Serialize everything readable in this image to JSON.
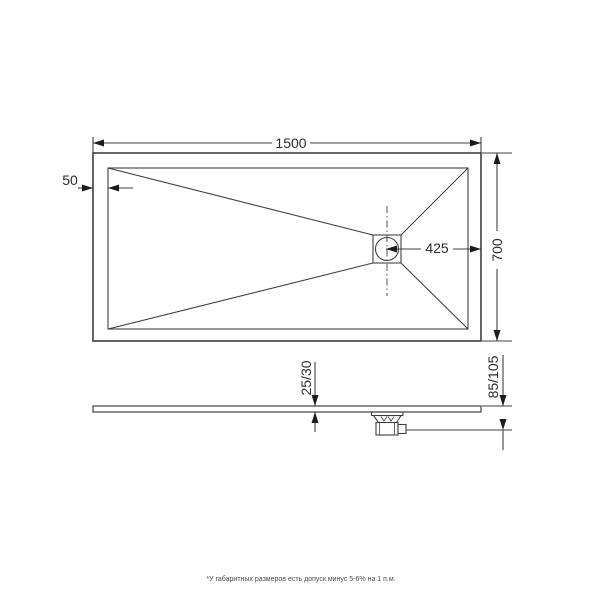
{
  "background": "#ffffff",
  "colors": {
    "line": "#3f3f3f",
    "arrow": "#1c1c1c",
    "text": "#2b2b2b",
    "footnote": "#4a4a4a"
  },
  "top_view": {
    "dim_length": "1500",
    "dim_width": "700",
    "dim_rim_offset": "50",
    "dim_drain_to_edge": "425"
  },
  "side_view": {
    "dim_rim_thickness": "25/30",
    "dim_overall_height": "85/105"
  },
  "footnote": "*У габаритных размеров есть допуск минус 5-6% на 1 п.м."
}
